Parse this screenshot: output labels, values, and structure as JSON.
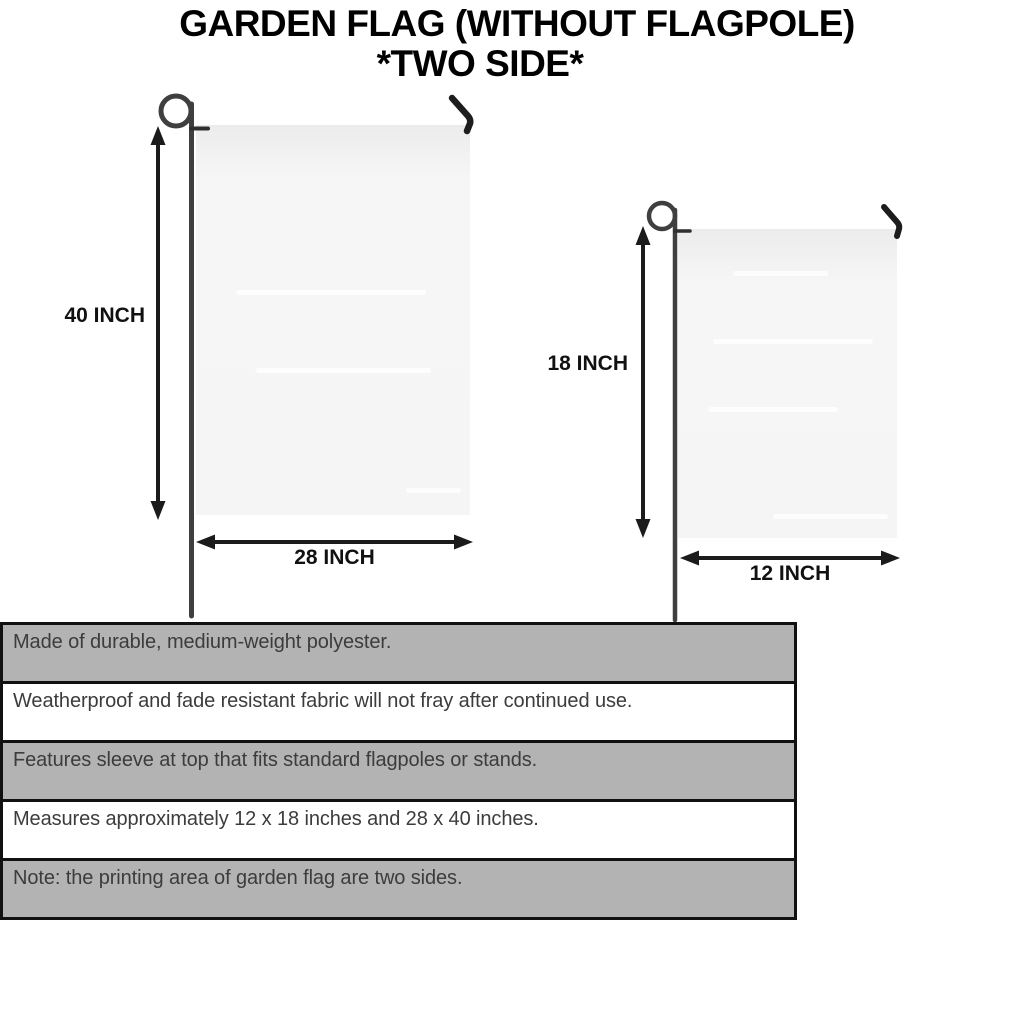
{
  "title": {
    "line1": "GARDEN FLAG (WITHOUT FLAGPOLE)",
    "line2": "*TWO SIDE*"
  },
  "diagram": {
    "large_flag": {
      "height_label": "40 INCH",
      "width_label": "28 INCH"
    },
    "small_flag": {
      "height_label": "18 INCH",
      "width_label": "12 INCH"
    }
  },
  "features": {
    "rows": [
      {
        "text": "Made of durable, medium-weight polyester.",
        "shaded": true
      },
      {
        "text": "Weatherproof and fade resistant fabric will not fray after continued use.",
        "shaded": false
      },
      {
        "text": "Features sleeve at top that fits standard flagpoles or stands.",
        "shaded": true
      },
      {
        "text": "Measures approximately 12 x 18 inches and 28 x 40 inches.",
        "shaded": false
      },
      {
        "text": "Note: the printing area of garden flag are two sides.",
        "shaded": true
      }
    ]
  },
  "colors": {
    "shaded_row": "#b3b3b3",
    "plain_row": "#ffffff",
    "table_border": "#111111",
    "flag_fill": "#f5f5f5",
    "pole": "#3f3f3f",
    "arrow": "#1b1b1b",
    "body_text": "#3c3c3c",
    "title_text": "#000000"
  }
}
